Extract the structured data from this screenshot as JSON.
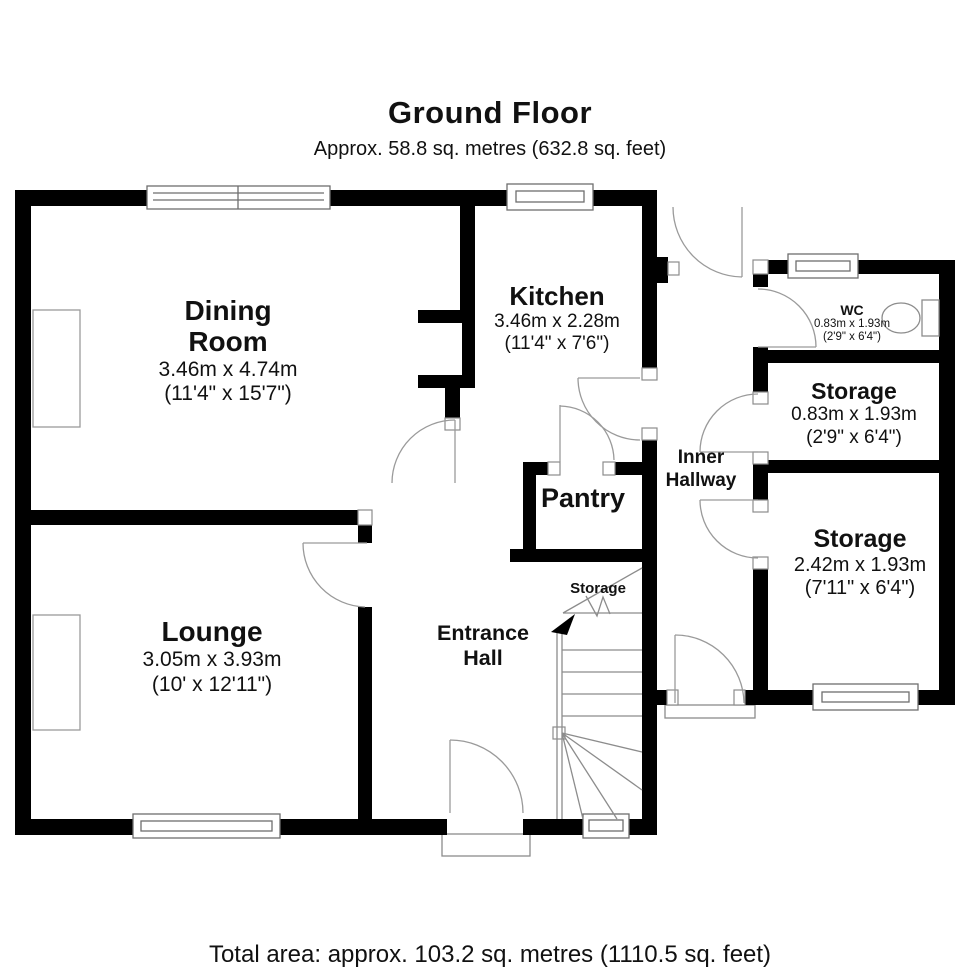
{
  "header": {
    "title": "Ground Floor",
    "subtitle": "Approx. 58.8 sq. metres (632.8 sq. feet)"
  },
  "footer": {
    "total_area": "Total area: approx. 103.2 sq. metres (1110.5 sq. feet)"
  },
  "rooms": [
    {
      "name": "Dining\nRoom",
      "dims_m": "3.46m x 4.74m",
      "dims_ft": "(11'4\" x 15'7\")"
    },
    {
      "name": "Kitchen",
      "dims_m": "3.46m x 2.28m",
      "dims_ft": "(11'4\" x 7'6\")"
    },
    {
      "name": "WC",
      "dims_m": "0.83m x 1.93m",
      "dims_ft": "(2'9\" x 6'4\")"
    },
    {
      "name": "Storage",
      "dims_m": "0.83m x 1.93m",
      "dims_ft": "(2'9\" x 6'4\")"
    },
    {
      "name": "Inner\nHallway"
    },
    {
      "name": "Storage",
      "dims_m": "2.42m x 1.93m",
      "dims_ft": "(7'11\" x 6'4\")"
    },
    {
      "name": "Pantry"
    },
    {
      "name": "Lounge",
      "dims_m": "3.05m x 3.93m",
      "dims_ft": "(10' x 12'11\")"
    },
    {
      "name": "Entrance\nHall"
    },
    {
      "name": "Storage"
    }
  ],
  "colors": {
    "wall": "#000000",
    "thin_line": "#8c8c8c",
    "background": "#ffffff",
    "text": "#111111"
  }
}
